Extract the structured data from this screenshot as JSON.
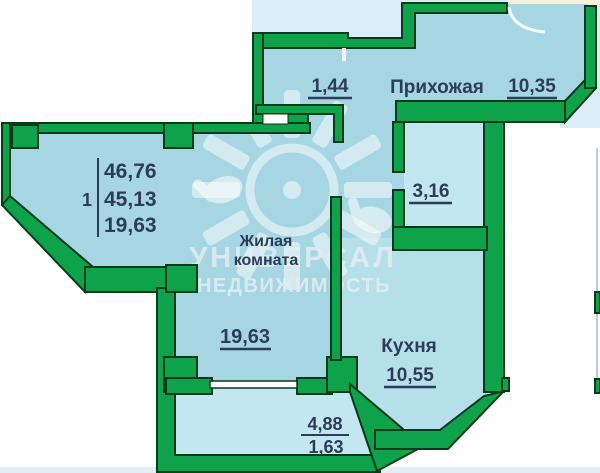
{
  "summary": {
    "unit_number": "1",
    "total_area": "46,76",
    "apartment_area": "45,13",
    "living_area": "19,63"
  },
  "rooms": {
    "hallway": {
      "name": "Прихожая",
      "area": "10,35"
    },
    "storage": {
      "area": "1,44"
    },
    "bathroom": {
      "area": "3,16"
    },
    "living_room": {
      "name_line1": "Жилая",
      "name_line2": "комната",
      "area": "19,63"
    },
    "kitchen": {
      "name": "Кухня",
      "area": "10,55"
    },
    "balcony": {
      "area_full": "4,88",
      "area_reduced": "1,63"
    }
  },
  "watermark": {
    "line1": "УНИВЕРСАЛ",
    "line2": "НЕДВИЖИМОСТЬ"
  },
  "palette": {
    "wall_green": "#0ea24b",
    "wall_outline": "#0a3a1c",
    "room_blue": "#a5d6e2",
    "room_blue_light": "#c2e7f0",
    "kitchen_blue": "#b5e0ea",
    "outside_blue": "#dbedf7",
    "cream": "#f7f2d8",
    "label_color": "#2d3c58"
  }
}
